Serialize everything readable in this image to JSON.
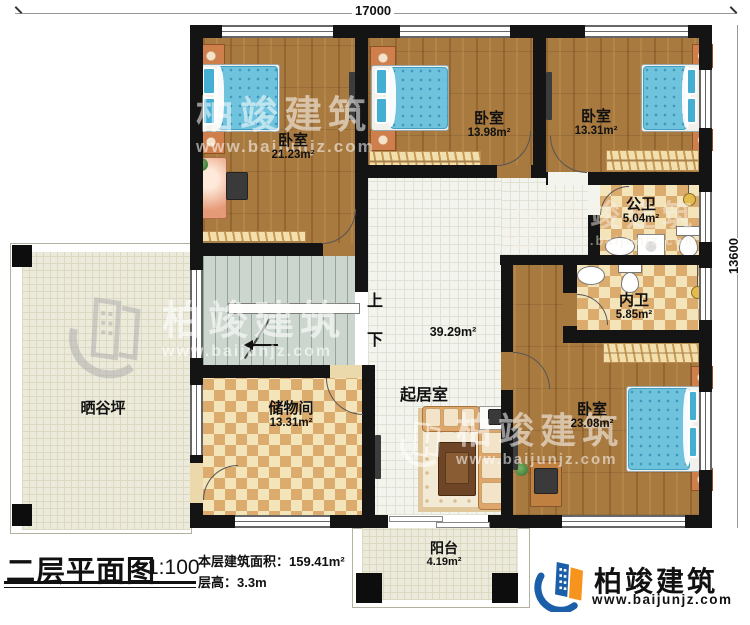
{
  "title_block": {
    "plan_name": "二层平面图",
    "scale": "1:100",
    "area_line": "本层建筑面积：159.41m²",
    "height_line": "层高：3.3m"
  },
  "dimensions": {
    "top_width": "17000",
    "right_height": "13600"
  },
  "rooms": {
    "bedroom_top_left": {
      "name": "卧室",
      "area": "21.23m²"
    },
    "bedroom_top_middle": {
      "name": "卧室",
      "area": "13.98m²"
    },
    "bedroom_top_right": {
      "name": "卧室",
      "area": "13.31m²"
    },
    "bedroom_bottom_right": {
      "name": "卧室",
      "area": "23.08m²"
    },
    "public_bathroom": {
      "name": "公卫",
      "area": "5.04m²"
    },
    "ensuite_bathroom": {
      "name": "内卫",
      "area": "5.85m²"
    },
    "storage_room": {
      "name": "储物间",
      "area": "13.31m²"
    },
    "living_room": {
      "name": "起居室",
      "area": "39.29m²"
    },
    "drying_terrace": {
      "name": "晒谷坪"
    },
    "balcony": {
      "name": "阳台",
      "area": "4.19m²"
    }
  },
  "stairs": {
    "up_label": "上",
    "down_label": "下"
  },
  "brand": {
    "name": "柏竣建筑",
    "website": "www.baijunjz.com"
  },
  "watermark": {
    "name": "柏竣建筑",
    "website": "www.baijunjz.com"
  },
  "colors": {
    "wall": "#141414",
    "wood_floor": "#a87a40",
    "checker_tan": "#dcab6e",
    "bed_blue": "#6fc3dd",
    "brand_blue": "#1a5fa8",
    "brand_orange": "#f7941d"
  }
}
